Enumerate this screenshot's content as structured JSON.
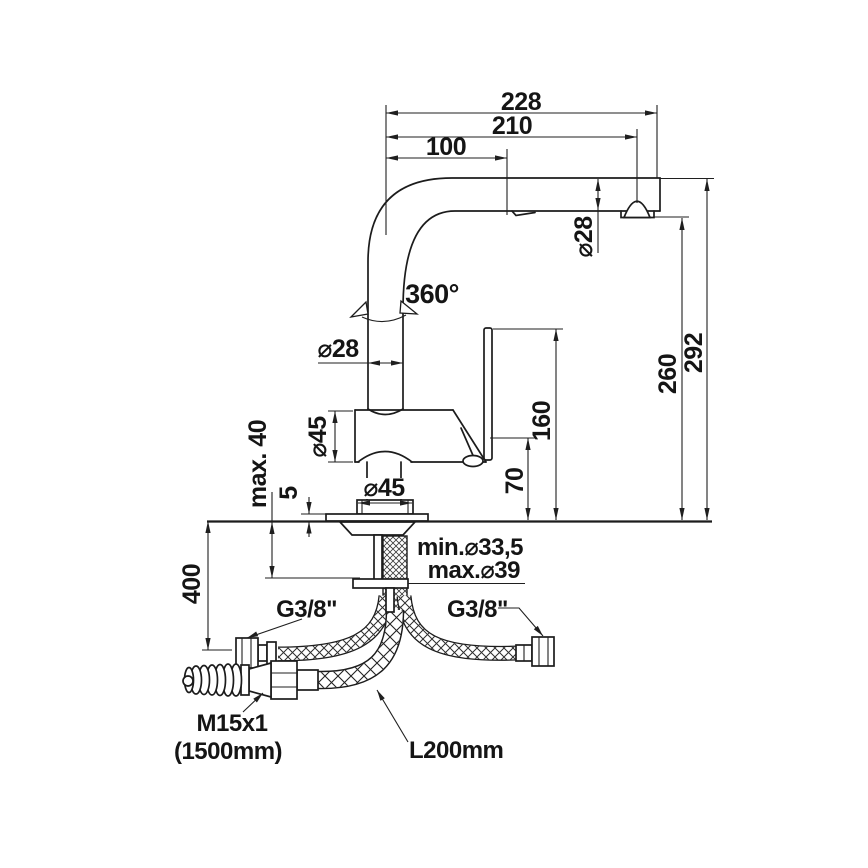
{
  "drawing": {
    "type": "technical-dimension-drawing",
    "subject": "single-lever kitchen mixer tap with pull-out spray and flexible supply hoses",
    "units": "mm",
    "colors": {
      "line": "#1c1c1c",
      "background": "#ffffff"
    },
    "dims": {
      "d228": "228",
      "d210": "210",
      "d100": "100",
      "phi28_spray": "⌀28",
      "swivel": "360°",
      "phi28_riser": "⌀28",
      "d292": "292",
      "d260": "260",
      "d160": "160",
      "d70": "70",
      "phi45_body": "⌀45",
      "phi45_base": "⌀45",
      "max40": "max. 40",
      "d5": "5",
      "d400": "400",
      "min_hole": "min.⌀33,5",
      "max_hole": "max.⌀39"
    },
    "labels": {
      "g38_left": "G3/8\"",
      "g38_right": "G3/8\"",
      "m15": "M15x1",
      "len1500": "(1500mm)",
      "l200": "L200mm"
    }
  }
}
